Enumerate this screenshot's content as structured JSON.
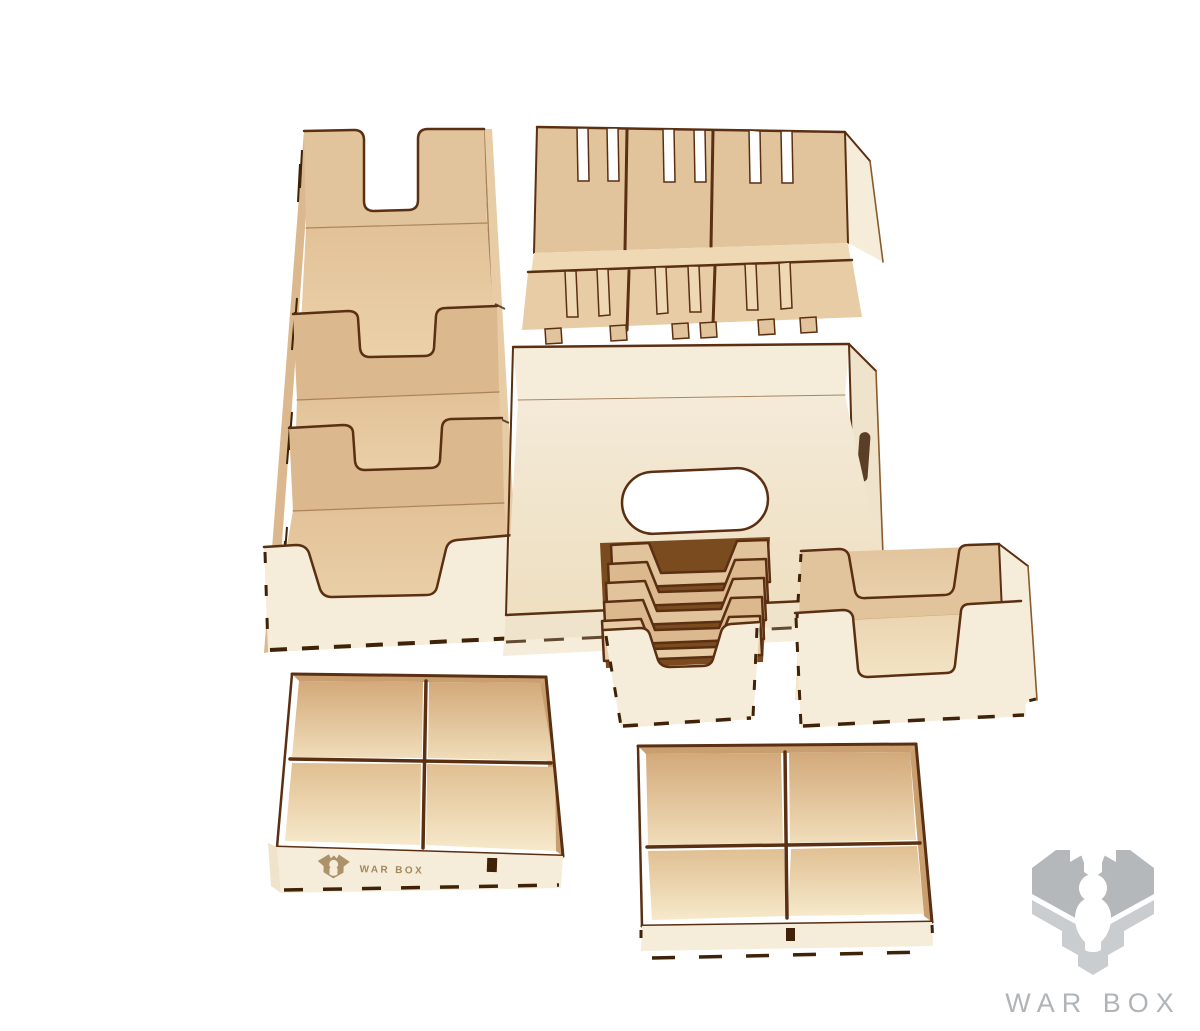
{
  "watermark": {
    "text": "WAR BOX"
  },
  "engraving": {
    "text": "WAR BOX"
  },
  "colors": {
    "bg": "#ffffff",
    "edge": "#5a2f12",
    "edgeLight": "#8a5a2b",
    "slotDark": "#3f2208",
    "woodFace": "#f5ecda",
    "woodFaceDim": "#efe3cc",
    "woodInner": "#e2c49c",
    "woodInnerDark": "#dbb88e",
    "woodInnerLight": "#e8cca6",
    "woodFloor": "#eed9b4",
    "woodBand": "#c99f70",
    "woodDeep": "#7b4b20",
    "floorTop": "#f4ead8",
    "floorBottom": "#eedfc0",
    "shadeTop": "#d3a97a",
    "litBottom": "#f0ddba",
    "shadeTop2": "#e0bf92",
    "litBottom2": "#f6e9ca",
    "fTop": "#e2c198",
    "fBottom": "#eed7ae",
    "logoDark": "#b4b8bb",
    "logoLight": "#c9cdd0",
    "logoText": "#b0b4b7",
    "engrave": "#a5875c"
  }
}
